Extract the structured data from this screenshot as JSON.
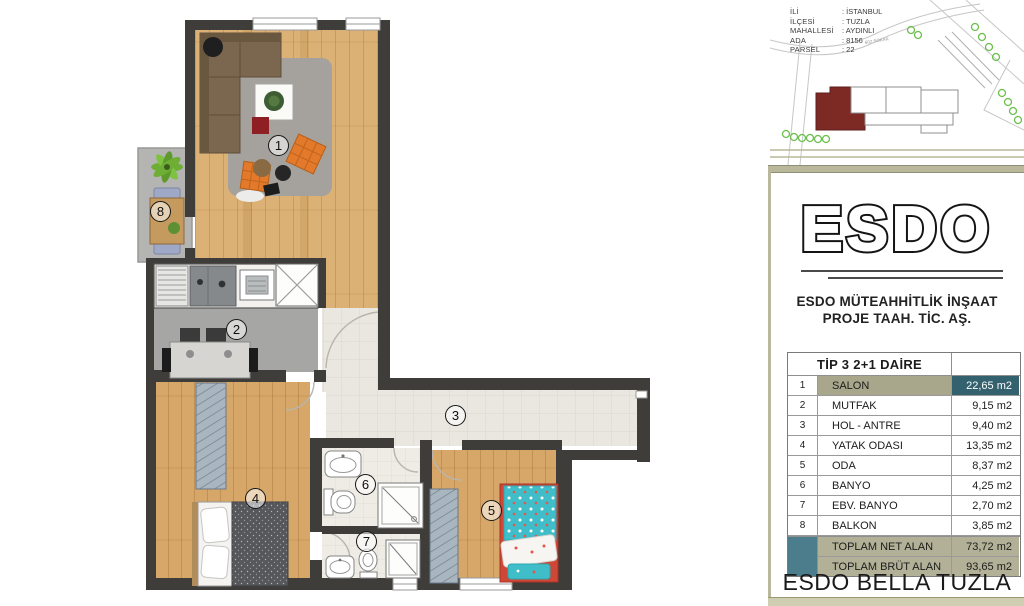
{
  "site_info": {
    "rows": [
      {
        "label": "İLİ",
        "value": ": İSTANBUL"
      },
      {
        "label": "İLÇESİ",
        "value": ": TUZLA"
      },
      {
        "label": "MAHALLESİ",
        "value": ": AYDINLI"
      },
      {
        "label": "ADA",
        "value": ": 8156"
      },
      {
        "label": "PARSEL",
        "value": ": 22"
      }
    ]
  },
  "map": {
    "street_label": "602 SOKAK"
  },
  "logo": {
    "brand": "ESDO",
    "company_line1": "ESDO MÜTEAHHİTLİK İNŞAAT",
    "company_line2": "PROJE TAAH. TİC. AŞ."
  },
  "table": {
    "title": "TİP 3  2+1 DAİRE",
    "rows": [
      {
        "no": "1",
        "name": "SALON",
        "area": "22,65 m2"
      },
      {
        "no": "2",
        "name": "MUTFAK",
        "area": "9,15 m2"
      },
      {
        "no": "3",
        "name": "HOL - ANTRE",
        "area": "9,40 m2"
      },
      {
        "no": "4",
        "name": "YATAK ODASI",
        "area": "13,35 m2"
      },
      {
        "no": "5",
        "name": "ODA",
        "area": "8,37 m2"
      },
      {
        "no": "6",
        "name": "BANYO",
        "area": "4,25 m2"
      },
      {
        "no": "7",
        "name": "EBV. BANYO",
        "area": "2,70 m2"
      },
      {
        "no": "8",
        "name": "BALKON",
        "area": "3,85 m2"
      }
    ],
    "totals": [
      {
        "name": "TOPLAM NET ALAN",
        "area": "73,72 m2"
      },
      {
        "name": "TOPLAM BRÜT ALAN",
        "area": "93,65 m2"
      }
    ]
  },
  "footer": {
    "project_name": "ESDO BELLA TUZLA"
  },
  "colors": {
    "wall": "#3f3d3a",
    "accent_teal": "#34616e",
    "accent_olive": "#a8a68b",
    "frame_olive": "#b9b89a",
    "map_highlight_red": "#7d2a24"
  }
}
